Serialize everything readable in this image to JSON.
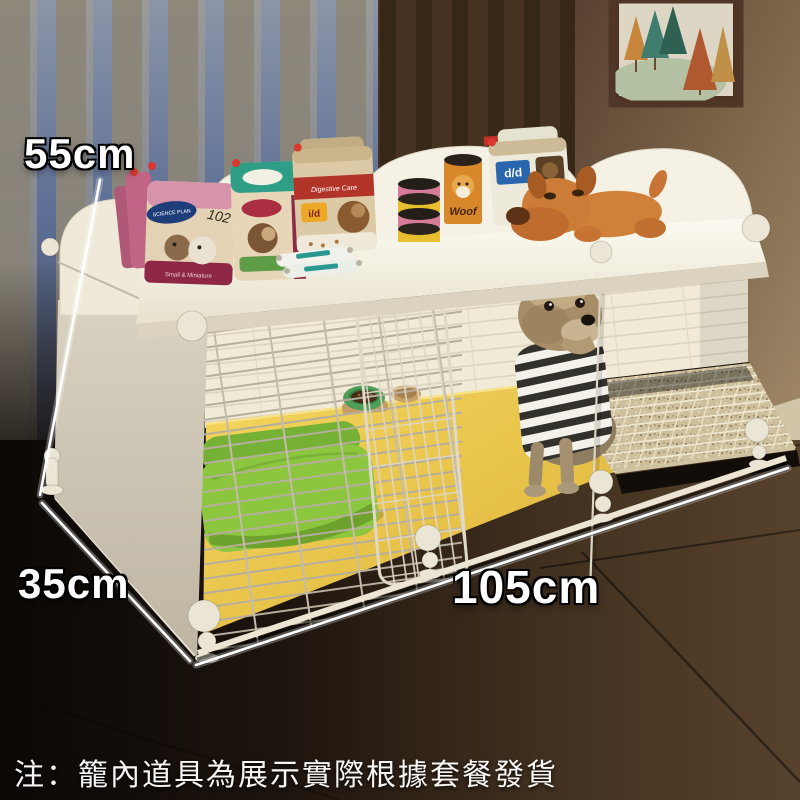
{
  "note": {
    "text": "注：籠內道具為展示實際根據套餐發貨"
  },
  "dimensions": {
    "height": "55cm",
    "depth": "35cm",
    "width": "105cm"
  },
  "products": {
    "science_plan_brand": "SCIENCE PLAN",
    "science_plan_variant": "Small & Miniature",
    "handwritten_code": "102",
    "digestive_line": "Digestive Care",
    "id_badge": "i/d",
    "dd_badge": "d/d",
    "woof_can": "Woof"
  },
  "colors": {
    "cage_white": "#f2eee0",
    "mat_yellow": "#ecc94d",
    "bed_green": "#8bc53f",
    "floor_dark": "#241a12",
    "wall_brown": "#8a7356",
    "dimension_text": "#ffffff"
  }
}
